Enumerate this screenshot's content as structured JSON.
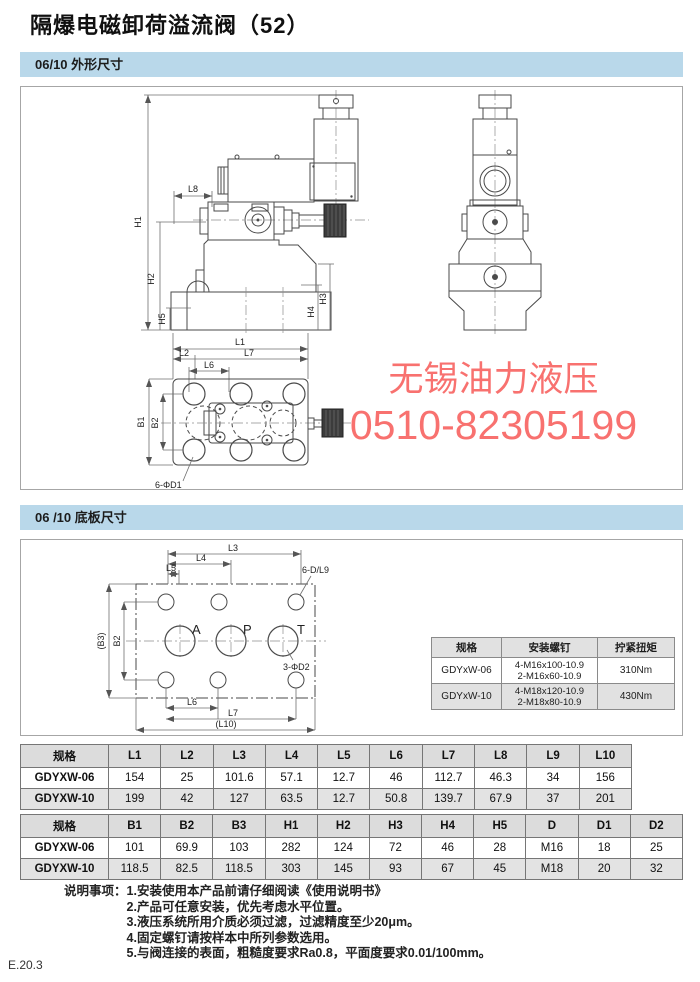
{
  "page": {
    "title": "隔爆电磁卸荷溢流阀（52）",
    "footer": "E.20.3"
  },
  "watermark": {
    "line1": "无锡油力液压",
    "line2": "0510-82305199"
  },
  "sections": [
    {
      "heading": "06/10 外形尺寸"
    },
    {
      "heading": "06 /10 底板尺寸"
    }
  ],
  "outline_drawing": {
    "labels": {
      "h1": "H1",
      "h2": "H2",
      "h3": "H3",
      "h4": "H4",
      "h5": "H5",
      "l8": "L8",
      "l1": "L1",
      "l2": "L2",
      "l6": "L6",
      "l7": "L7",
      "b1": "B1",
      "b2": "B2",
      "hole_note": "6-ΦD1"
    }
  },
  "baseplate_drawing": {
    "labels": {
      "l3": "L3",
      "l4": "L4",
      "l5": "L5",
      "l6": "L6",
      "l7": "L7",
      "l10": "(L10)",
      "b2": "B2",
      "b3": "(B3)",
      "hole_note_6": "6-D/L9",
      "hole_note_3": "3-ΦD2",
      "port_a": "A",
      "port_p": "P",
      "port_t": "T"
    }
  },
  "screw_table": {
    "headers": [
      "规格",
      "安装螺钉",
      "拧紧扭矩"
    ],
    "rows": [
      {
        "spec": "GDYxW-06",
        "screw1": "4-M16x100-10.9",
        "screw2": "2-M16x60-10.9",
        "torque": "310Nm"
      },
      {
        "spec": "GDYxW-10",
        "screw1": "4-M18x120-10.9",
        "screw2": "2-M18x80-10.9",
        "torque": "430Nm"
      }
    ]
  },
  "l_table": {
    "headers": [
      "规格",
      "L1",
      "L2",
      "L3",
      "L4",
      "L5",
      "L6",
      "L7",
      "L8",
      "L9",
      "L10"
    ],
    "rows": [
      [
        "GDYXW-06",
        "154",
        "25",
        "101.6",
        "57.1",
        "12.7",
        "46",
        "112.7",
        "46.3",
        "34",
        "156"
      ],
      [
        "GDYXW-10",
        "199",
        "42",
        "127",
        "63.5",
        "12.7",
        "50.8",
        "139.7",
        "67.9",
        "37",
        "201"
      ]
    ]
  },
  "bhd_table": {
    "headers": [
      "规格",
      "B1",
      "B2",
      "B3",
      "H1",
      "H2",
      "H3",
      "H4",
      "H5",
      "D",
      "D1",
      "D2"
    ],
    "rows": [
      [
        "GDYXW-06",
        "101",
        "69.9",
        "103",
        "282",
        "124",
        "72",
        "46",
        "28",
        "M16",
        "18",
        "25"
      ],
      [
        "GDYXW-10",
        "118.5",
        "82.5",
        "118.5",
        "303",
        "145",
        "93",
        "67",
        "45",
        "M18",
        "20",
        "32"
      ]
    ]
  },
  "notes": {
    "label": "说明事项：",
    "items": [
      "1.安装使用本产品前请仔细阅读《使用说明书》",
      "2.产品可任意安装，优先考虑水平位置。",
      "3.液压系统所用介质必须过滤，过滤精度至少20μm。",
      "4.固定螺钉请按样本中所列参数选用。",
      "5.与阀连接的表面，粗糙度要求Ra0.8，平面度要求0.01/100mm。"
    ]
  },
  "colors": {
    "section_bar": "#b9d8ea",
    "table_header_bg": "#dcdcdc",
    "table_alt_row_bg": "#e3e3e3",
    "watermark": "#f8716f"
  }
}
